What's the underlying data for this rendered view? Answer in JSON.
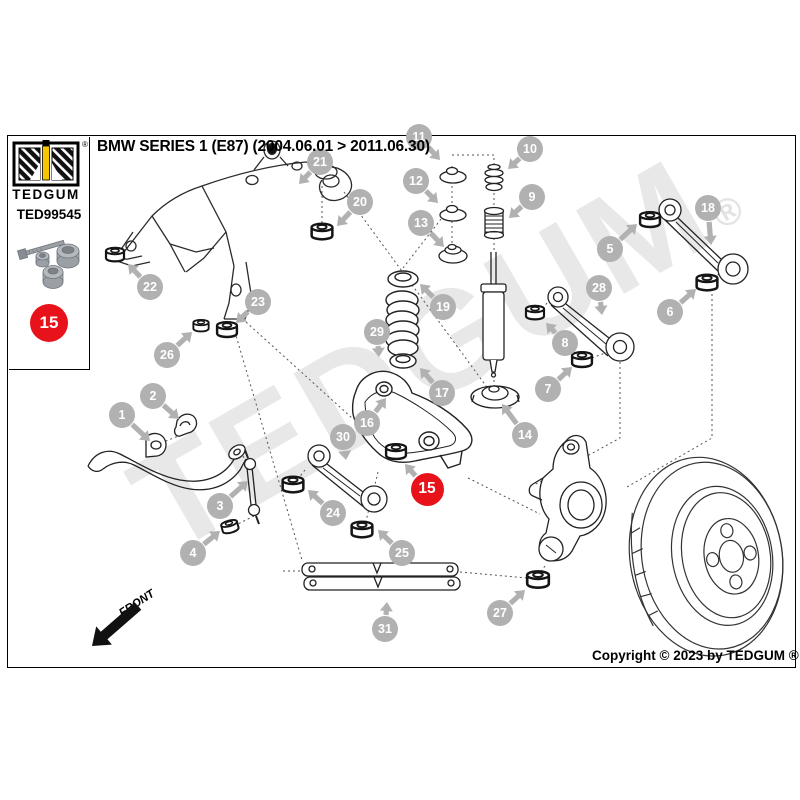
{
  "header": {
    "title": "BMW SERIES 1 (E87) (2004.06.01 > 2011.06.30)"
  },
  "sidebar": {
    "brand": "TEDGUM",
    "registered": "®",
    "part_number": "TED99545",
    "badge_number": "15"
  },
  "watermark": {
    "text": "TEDGUM",
    "registered": "®"
  },
  "front_label": "FRONT",
  "footer": {
    "copyright": "Copyright © 2023 by TEDGUM ®"
  },
  "diagram": {
    "colors": {
      "callout": "#b1b1b1",
      "highlight": "#e8121a"
    },
    "callouts": [
      {
        "n": "1",
        "x": 122,
        "y": 415,
        "tx": 150,
        "ty": 441
      },
      {
        "n": "2",
        "x": 153,
        "y": 396,
        "tx": 179,
        "ty": 419
      },
      {
        "n": "3",
        "x": 220,
        "y": 506,
        "tx": 248,
        "ty": 481
      },
      {
        "n": "4",
        "x": 193,
        "y": 553,
        "tx": 220,
        "ty": 531
      },
      {
        "n": "5",
        "x": 610,
        "y": 249,
        "tx": 637,
        "ty": 224
      },
      {
        "n": "6",
        "x": 670,
        "y": 312,
        "tx": 696,
        "ty": 289
      },
      {
        "n": "7",
        "x": 548,
        "y": 389,
        "tx": 572,
        "ty": 367
      },
      {
        "n": "8",
        "x": 565,
        "y": 343,
        "tx": 546,
        "ty": 323
      },
      {
        "n": "9",
        "x": 532,
        "y": 197,
        "tx": 509,
        "ty": 218
      },
      {
        "n": "10",
        "x": 530,
        "y": 149,
        "tx": 508,
        "ty": 169
      },
      {
        "n": "11",
        "x": 419,
        "y": 137,
        "tx": 440,
        "ty": 160
      },
      {
        "n": "12",
        "x": 416,
        "y": 181,
        "tx": 438,
        "ty": 203
      },
      {
        "n": "13",
        "x": 421,
        "y": 223,
        "tx": 444,
        "ty": 247
      },
      {
        "n": "14",
        "x": 525,
        "y": 435,
        "tx": 502,
        "ty": 404
      },
      {
        "n": "16",
        "x": 367,
        "y": 423,
        "tx": 386,
        "ty": 398
      },
      {
        "n": "17",
        "x": 442,
        "y": 393,
        "tx": 420,
        "ty": 368
      },
      {
        "n": "18",
        "x": 708,
        "y": 208,
        "tx": 711,
        "ty": 245
      },
      {
        "n": "19",
        "x": 443,
        "y": 307,
        "tx": 420,
        "ty": 284
      },
      {
        "n": "20",
        "x": 360,
        "y": 202,
        "tx": 337,
        "ty": 226
      },
      {
        "n": "21",
        "x": 320,
        "y": 162,
        "tx": 299,
        "ty": 184
      },
      {
        "n": "22",
        "x": 150,
        "y": 287,
        "tx": 128,
        "ty": 264
      },
      {
        "n": "23",
        "x": 258,
        "y": 302,
        "tx": 236,
        "ty": 323
      },
      {
        "n": "24",
        "x": 333,
        "y": 513,
        "tx": 308,
        "ty": 490
      },
      {
        "n": "25",
        "x": 402,
        "y": 553,
        "tx": 378,
        "ty": 530
      },
      {
        "n": "26",
        "x": 167,
        "y": 355,
        "tx": 192,
        "ty": 332
      },
      {
        "n": "27",
        "x": 500,
        "y": 613,
        "tx": 525,
        "ty": 590
      },
      {
        "n": "28",
        "x": 599,
        "y": 288,
        "tx": 602,
        "ty": 315
      },
      {
        "n": "29",
        "x": 377,
        "y": 332,
        "tx": 379,
        "ty": 357
      },
      {
        "n": "30",
        "x": 343,
        "y": 437,
        "tx": 346,
        "ty": 460
      },
      {
        "n": "31",
        "x": 385,
        "y": 629,
        "tx": 387,
        "ty": 602
      }
    ],
    "highlight": {
      "n": "15",
      "x": 427,
      "y": 489,
      "tx": 405,
      "ty": 464
    }
  }
}
